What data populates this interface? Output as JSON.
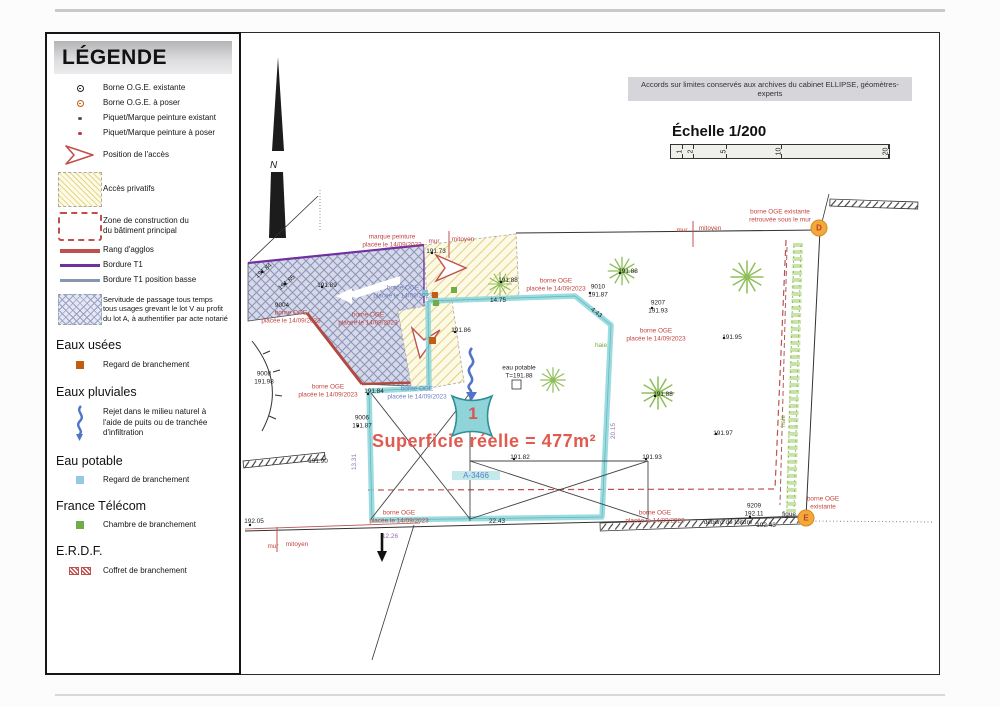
{
  "colors": {
    "accent_red": "#c0504d",
    "teal": "#8ad6da",
    "purple": "#7030a0",
    "slate": "#8496b0",
    "orange_marker": "#f2a93b",
    "yellow_hatch": "#e6d584",
    "cross_hatch": "#98a0c4"
  },
  "legend": {
    "title": "LÉGENDE",
    "items": [
      {
        "icon": "borne-oge-existante-icon",
        "label": "Borne O.G.E. existante"
      },
      {
        "icon": "borne-oge-a-poser-icon",
        "label": "Borne O.G.E. à poser"
      },
      {
        "icon": "piquet-existant-icon",
        "label": "Piquet/Marque peinture existant"
      },
      {
        "icon": "piquet-a-poser-icon",
        "label": "Piquet/Marque peinture à poser"
      },
      {
        "icon": "position-acces-icon",
        "label": "Position de l'accès"
      },
      {
        "icon": "acces-privatifs-icon",
        "label": "Accès privatifs"
      },
      {
        "icon": "zone-construction-icon",
        "label": "Zone de construction du\ndu bâtiment principal"
      },
      {
        "icon": "rang-agglos-icon",
        "label": "Rang d'agglos"
      },
      {
        "icon": "bordure-t1-icon",
        "label": "Bordure T1"
      },
      {
        "icon": "bordure-t1-basse-icon",
        "label": "Bordure T1 position basse"
      },
      {
        "icon": "servitude-icon",
        "label": "Servitude de passage tous temps\ntous usages grevant le lot V au profit\ndu lot A, à authentifier par acte notarié"
      }
    ],
    "sections": [
      {
        "title": "Eaux usées",
        "items": [
          {
            "icon": "regard-eu-icon",
            "label": "Regard de branchement"
          }
        ]
      },
      {
        "title": "Eaux pluviales",
        "items": [
          {
            "icon": "rejet-icon",
            "label": "Rejet dans le milieu naturel à\nl'aide de puits ou de tranchée\nd'infiltration"
          }
        ]
      },
      {
        "title": "Eau potable",
        "items": [
          {
            "icon": "regard-ep-icon",
            "label": "Regard de branchement"
          }
        ]
      },
      {
        "title": "France Télécom",
        "items": [
          {
            "icon": "chambre-ft-icon",
            "label": "Chambre de branchement"
          }
        ]
      },
      {
        "title": "E.R.D.F.",
        "items": [
          {
            "icon": "coffret-icon",
            "label": "Coffret de branchement"
          }
        ]
      }
    ]
  },
  "plan": {
    "north_label": "N",
    "archive_note": "Accords sur limites conservés aux archives du cabinet ELLIPSE, géomètres-experts",
    "scale": {
      "title": "Échelle 1/200",
      "ticks": [
        "1",
        "2",
        "5",
        "10",
        "20"
      ]
    },
    "area_text": "Superficie réelle = 477m²",
    "parcel_id": "A-3466",
    "lot_number": "1",
    "marker_d": "D",
    "marker_e": "E",
    "labels": [
      "marque peinture\nplacée le 14/09/2023",
      "mur",
      "mitoyen",
      "mur",
      "mitoyen",
      "borne OGE existante\nretrouvée sous le mur",
      "borne OGE\nplacée le 14/09/2023",
      "borne OGE\nplacée le 14/09/2023",
      "borne OGE\nplacée le 14/09/2023",
      "borne OGE\nplacée le 14/09/2023",
      "borne OGE\nplacée le 14/09/2023",
      "borne OGE\nplacée le 14/09/2023",
      "borne OGE\nplacée le 14/09/2023",
      "borne OGE\nplacée le 14/09/2023",
      "borne OGE\nplacée le 14/09/2023",
      "borne OGE\nexistante",
      "mur",
      "mitoyen",
      "9004",
      "191.84",
      "191.85",
      "191.89",
      "191.73",
      "191.88",
      "9010\n191.87",
      "9207\n191.93",
      "191.88",
      "191.95",
      "191.88",
      "191.97",
      "191.86",
      "eau potable\nT=191.88",
      "9008\n191.98",
      "191.84",
      "9006\n191.87",
      "191.82",
      "191.93",
      "9209\n192.11",
      "débord de toiture",
      "192.43",
      "figue",
      "192.05",
      "191.90",
      "14.75",
      "4.43",
      "22.43",
      "13.31",
      "12.26",
      "20.15",
      "haie",
      "haie"
    ]
  }
}
